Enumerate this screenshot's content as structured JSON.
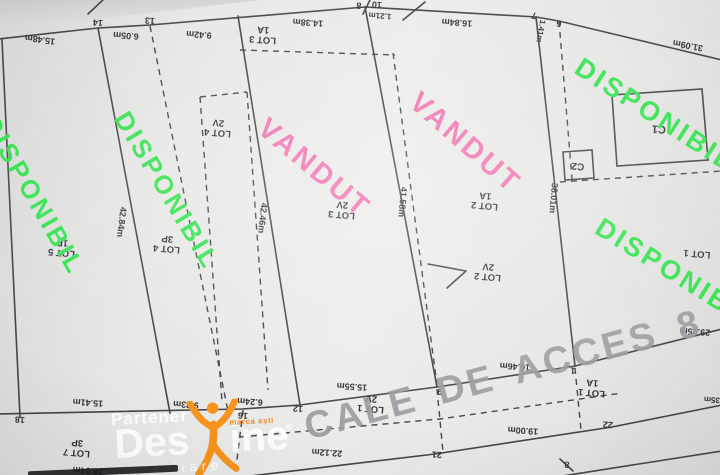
{
  "plan": {
    "road": {
      "text": "CALE DE ACCES 8 M",
      "x": 300,
      "y": 408,
      "rot": -15,
      "size": 38,
      "color": "#9b9ba0"
    },
    "overlays": [
      {
        "text": "DISPONIBIL",
        "x": 2,
        "y": 110,
        "rot": 60,
        "size": 26,
        "color": "#35e24e"
      },
      {
        "text": "DISPONIBIL",
        "x": 134,
        "y": 106,
        "rot": 59,
        "size": 26,
        "color": "#35e24e"
      },
      {
        "text": "VANDUT",
        "x": 272,
        "y": 112,
        "rot": 40,
        "size": 29,
        "color": "#f173ae"
      },
      {
        "text": "VANDUT",
        "x": 424,
        "y": 86,
        "rot": 41,
        "size": 29,
        "color": "#f173ae"
      },
      {
        "text": "DISPONIBIL",
        "x": 586,
        "y": 52,
        "rot": 33,
        "size": 27,
        "color": "#35e24e"
      },
      {
        "text": "DISPONIBIL",
        "x": 606,
        "y": 212,
        "rot": 32,
        "size": 27,
        "color": "#35e24e"
      }
    ],
    "lots": [
      {
        "line1": "LOT 5",
        "line2": "1P",
        "x": 62,
        "y": 247,
        "rot": 185
      },
      {
        "line1": "LOT 4",
        "line2": "3P",
        "x": 167,
        "y": 243,
        "rot": 185
      },
      {
        "line1": "LOT 4",
        "line2": "2V",
        "x": 218,
        "y": 127,
        "rot": 185
      },
      {
        "line1": "LOT 3",
        "line2": "1A",
        "x": 263,
        "y": 34,
        "rot": 184
      },
      {
        "line1": "LOT 3",
        "line2": "2V",
        "x": 342,
        "y": 209,
        "rot": 185
      },
      {
        "line1": "LOT 2",
        "line2": "1A",
        "x": 485,
        "y": 200,
        "rot": 185
      },
      {
        "line1": "LOT 2",
        "line2": "2V",
        "x": 488,
        "y": 271,
        "rot": 185
      },
      {
        "line1": "LOT 1",
        "line2": "",
        "x": 697,
        "y": 253,
        "rot": 185
      },
      {
        "line1": "LOT 1",
        "line2": "1A",
        "x": 592,
        "y": 387,
        "rot": 185
      },
      {
        "line1": "LOT 1",
        "line2": "2V",
        "x": 371,
        "y": 403,
        "rot": 185
      },
      {
        "line1": "LOT 7",
        "line2": "3P",
        "x": 77,
        "y": 447,
        "rot": 185
      }
    ],
    "buildings": [
      {
        "text": "C1",
        "x": 659,
        "y": 128,
        "rot": 184,
        "size": 11
      },
      {
        "text": "C2",
        "x": 578,
        "y": 165,
        "rot": 184,
        "size": 10
      }
    ],
    "points": [
      {
        "text": "14",
        "x": 98,
        "y": 22
      },
      {
        "text": "13",
        "x": 150,
        "y": 20
      },
      {
        "text": "8",
        "x": 359,
        "y": 5
      },
      {
        "text": "10",
        "x": 377,
        "y": 4
      },
      {
        "text": "7",
        "x": 534,
        "y": 15
      },
      {
        "text": "6",
        "x": 559,
        "y": 23
      },
      {
        "text": "18",
        "x": 20,
        "y": 419
      },
      {
        "text": "16",
        "x": 243,
        "y": 415
      },
      {
        "text": "12",
        "x": 298,
        "y": 408
      },
      {
        "text": "9",
        "x": 440,
        "y": 391
      },
      {
        "text": "1",
        "x": 573,
        "y": 370
      },
      {
        "text": "21",
        "x": 437,
        "y": 454
      },
      {
        "text": "22",
        "x": 608,
        "y": 424
      },
      {
        "text": "8",
        "x": 567,
        "y": 464
      }
    ],
    "measurements": [
      {
        "text": "15.48m",
        "x": 40,
        "y": 39,
        "rot": 188
      },
      {
        "text": "6.05m",
        "x": 126,
        "y": 35
      },
      {
        "text": "9.42m",
        "x": 199,
        "y": 34
      },
      {
        "text": "14.38m",
        "x": 308,
        "y": 22
      },
      {
        "text": "1.21m",
        "x": 380,
        "y": 15,
        "size": 8
      },
      {
        "text": "16.84m",
        "x": 457,
        "y": 22
      },
      {
        "text": "31.09m",
        "x": 688,
        "y": 45,
        "rot": 191
      },
      {
        "text": "1.41m",
        "x": 540,
        "y": 31,
        "rot": 100,
        "size": 8
      },
      {
        "text": "42.84m",
        "x": 121,
        "y": 222,
        "rot": 97
      },
      {
        "text": "42.46m",
        "x": 262,
        "y": 218,
        "rot": 96
      },
      {
        "text": "41.58m",
        "x": 402,
        "y": 202,
        "rot": 95
      },
      {
        "text": "38.01m",
        "x": 553,
        "y": 198,
        "rot": 95
      },
      {
        "text": "15.41m",
        "x": 88,
        "y": 402
      },
      {
        "text": "9.23m",
        "x": 186,
        "y": 404
      },
      {
        "text": "6.24m",
        "x": 250,
        "y": 401
      },
      {
        "text": "15.55m",
        "x": 352,
        "y": 386
      },
      {
        "text": "16.46m",
        "x": 515,
        "y": 366
      },
      {
        "text": "29.35m",
        "x": 695,
        "y": 331
      },
      {
        "text": "22.12m",
        "x": 327,
        "y": 452
      },
      {
        "text": "19.00m",
        "x": 523,
        "y": 430
      },
      {
        "text": "38.04m",
        "x": 88,
        "y": 470
      },
      {
        "text": "35m",
        "x": 712,
        "y": 399,
        "size": 8
      }
    ]
  },
  "watermark": {
    "partener": "Partener",
    "brand_a": "Des",
    "brand_b": "ine",
    "reg": "®",
    "tagline": "marca ești",
    "subtitle": "imobiliare"
  },
  "colors": {
    "available": "#35e24e",
    "sold": "#f173ae",
    "road_text": "#9b9ba0",
    "plan_line": "#45454a",
    "paper": "#e9e9e7",
    "logo_orange": "#f7941e",
    "logo_white": "#ffffff"
  }
}
